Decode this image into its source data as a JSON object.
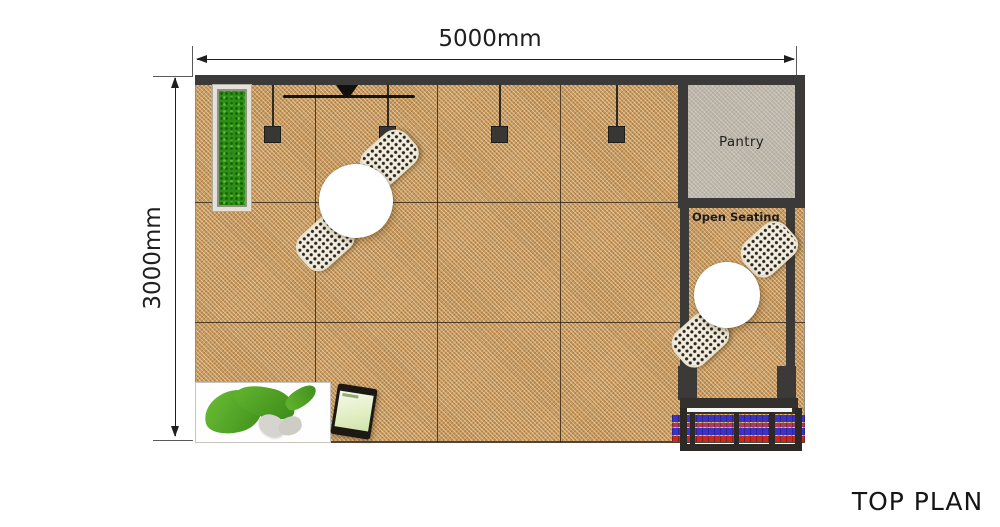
{
  "title": {
    "label": "TOP PLAN"
  },
  "dimensions": {
    "width": "5000mm",
    "height": "3000mm"
  },
  "rooms": {
    "pantry": {
      "label": "Pantry"
    },
    "open_seating": {
      "label": "Open Seating"
    }
  },
  "furniture": {
    "round_tables": 2,
    "dotted_chairs": 4,
    "hanging_lights": 4,
    "planter": "green-moss-planter",
    "wall_display": "wall-mounted-screen",
    "bean_bag": "green-bean-bag-with-pillow",
    "tablet": "tablet-kiosk",
    "flower_bed": "striped-flower-railing"
  },
  "colors": {
    "wall_dark": "#3b3a38",
    "floor_base": "#c8995e",
    "pantry_fill": "#bdb6a9",
    "planter_green": "#2e8f17",
    "chair_fill": "#f2edde",
    "chair_dot": "#27231d",
    "table_white": "#ffffff",
    "stripe_indigo": "#3d32c8",
    "stripe_magenta": "#a83a62",
    "stripe_red": "#c52a1e",
    "mat_white": "#fefefe",
    "beanbag_green": "#55ad28",
    "dim_line": "#1f1f1f",
    "text_dark": "#1c1c1c"
  }
}
